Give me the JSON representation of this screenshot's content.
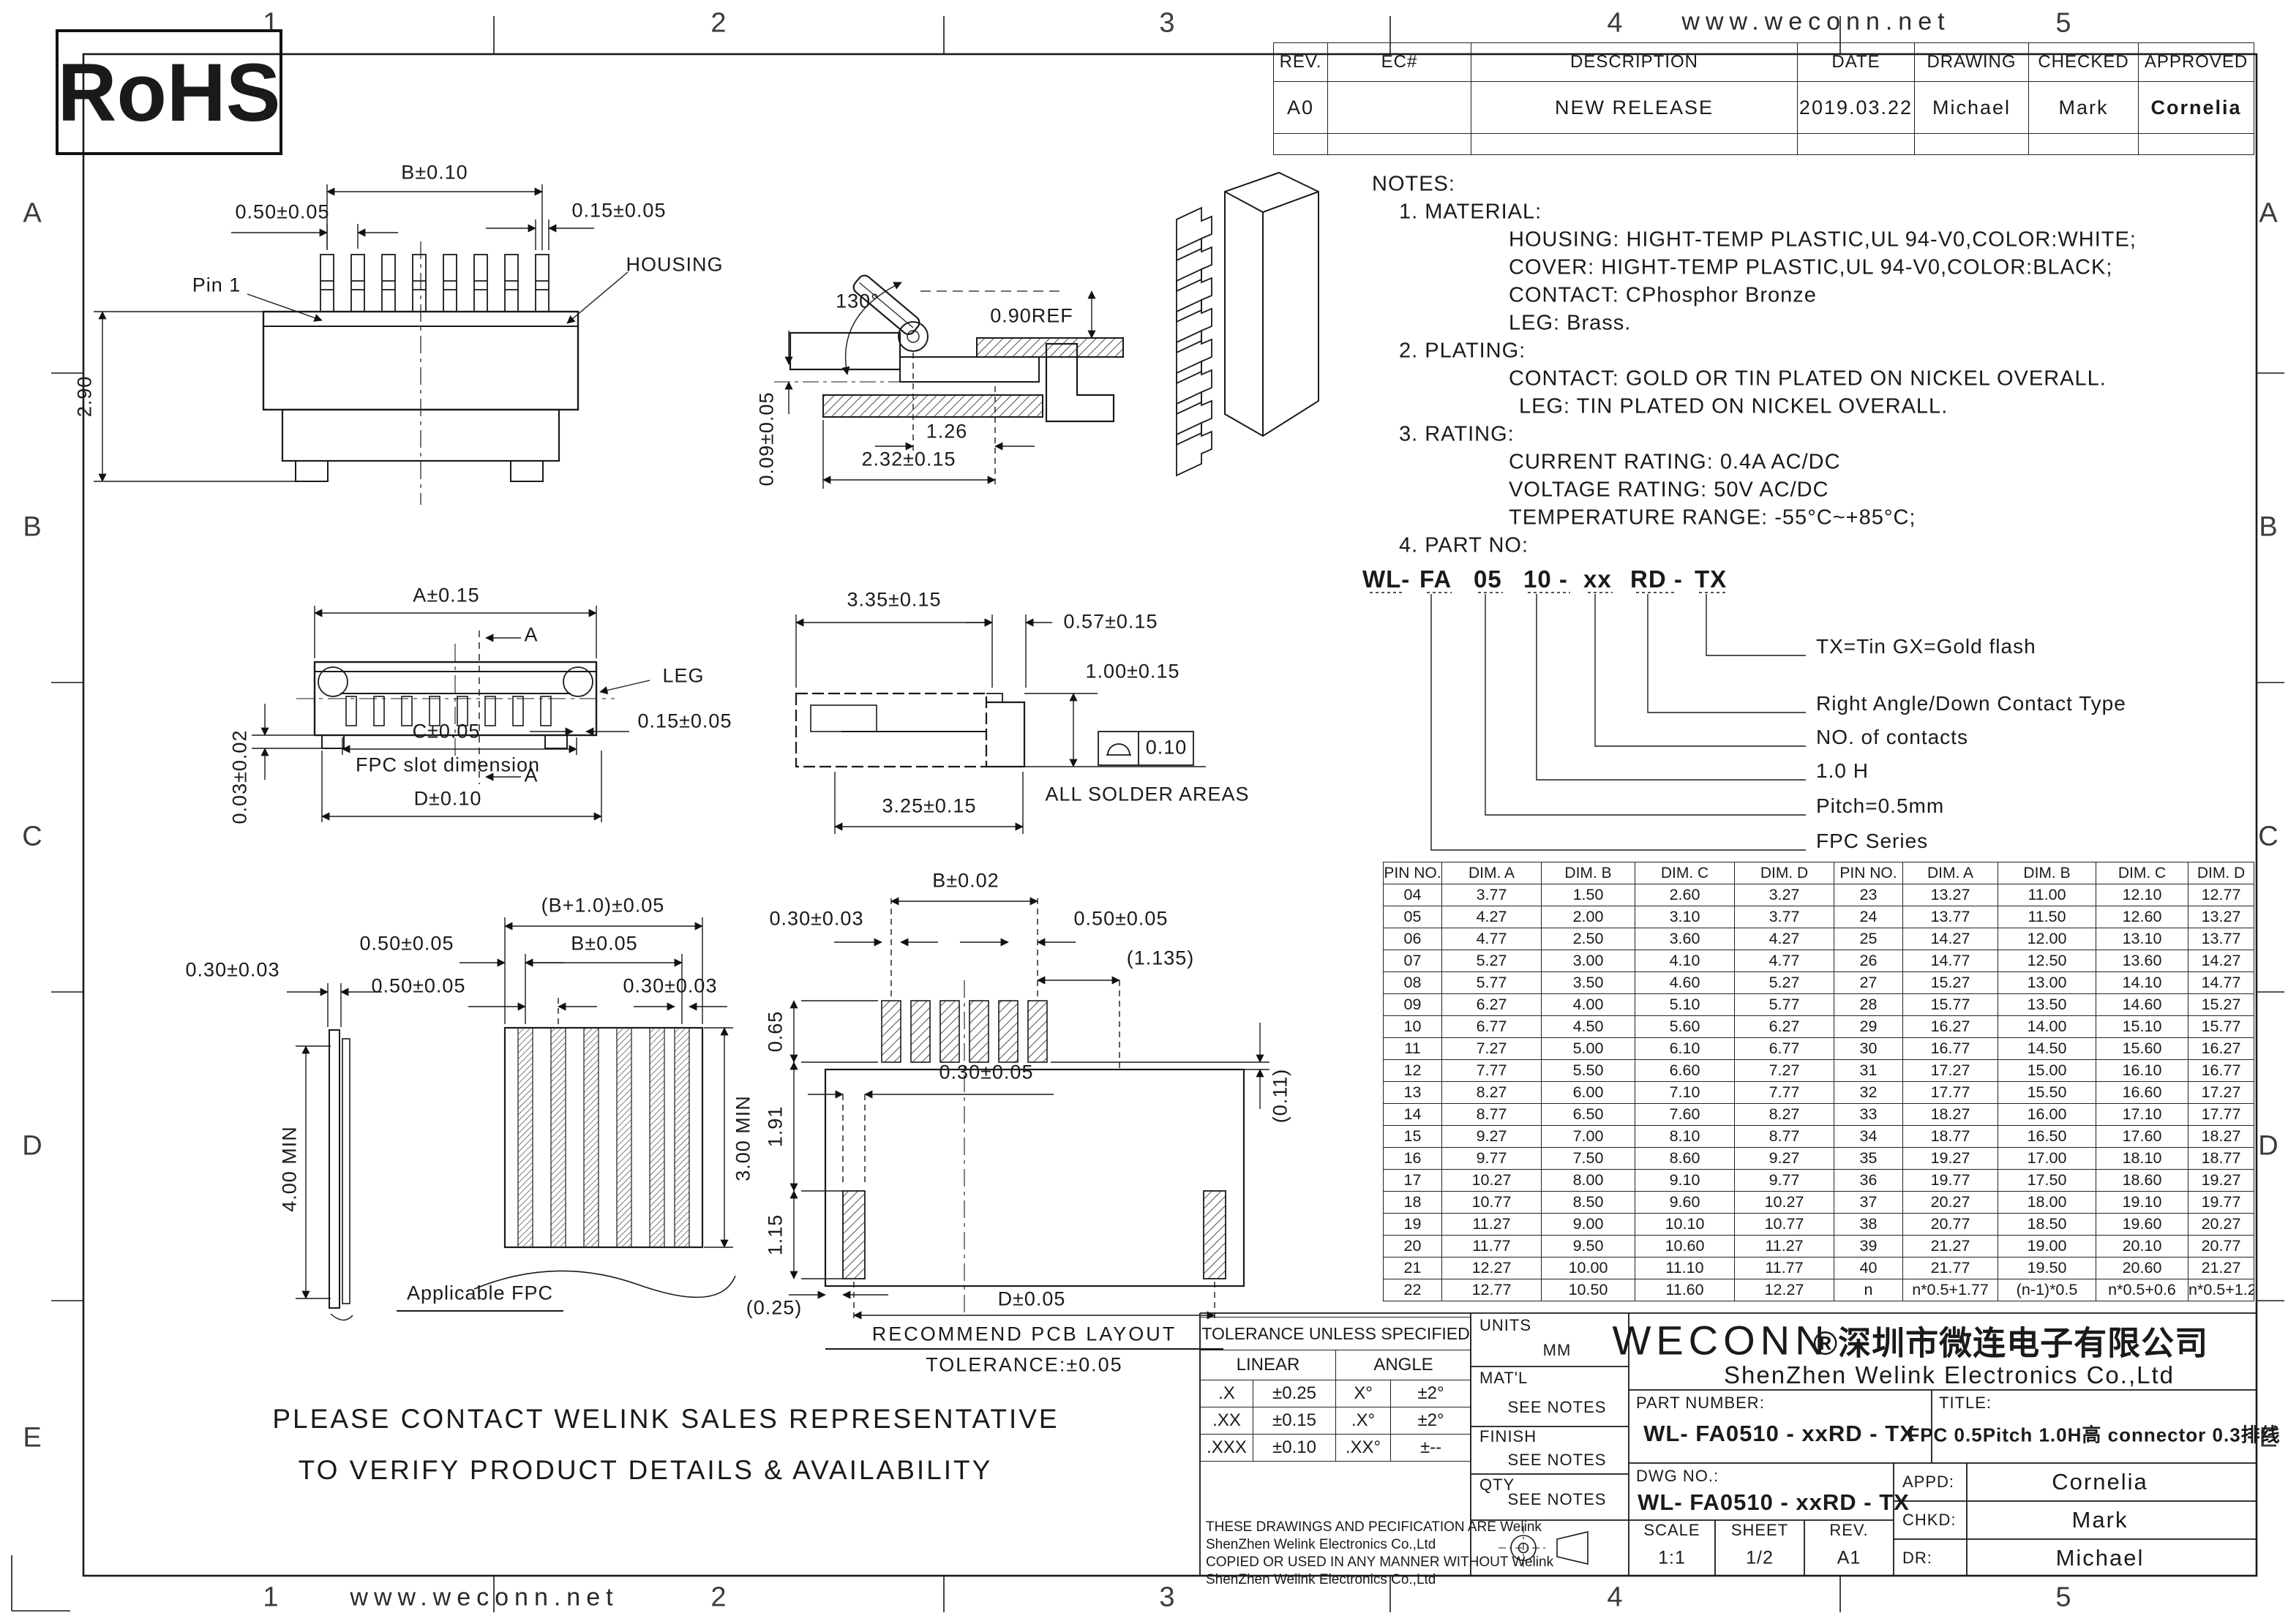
{
  "page": {
    "site": "www.weconn.net",
    "rohs": "RoHS",
    "zone_cols": [
      "1",
      "2",
      "3",
      "4",
      "5"
    ],
    "zone_rows": [
      "A",
      "B",
      "C",
      "D",
      "E"
    ],
    "footer_line1": "PLEASE CONTACT WELINK SALES REPRESENTATIVE",
    "footer_line2": "TO VERIFY PRODUCT DETAILS & AVAILABILITY"
  },
  "rev_table": {
    "headers": [
      "REV.",
      "EC#",
      "DESCRIPTION",
      "DATE",
      "DRAWING",
      "CHECKED",
      "APPROVED"
    ],
    "row": {
      "rev": "A0",
      "ec": "",
      "description": "NEW RELEASE",
      "date": "2019.03.22",
      "drawing": "Michael",
      "checked": "Mark",
      "approved": "Cornelia"
    }
  },
  "notes": {
    "l0": "NOTES:",
    "l1": "1. MATERIAL:",
    "l2": "HOUSING: HIGHT-TEMP PLASTIC,UL 94-V0,COLOR:WHITE;",
    "l3": "COVER: HIGHT-TEMP PLASTIC,UL 94-V0,COLOR:BLACK;",
    "l4": "CONTACT: CPhosphor Bronze",
    "l5": "LEG: Brass.",
    "l6": "2. PLATING:",
    "l7": "CONTACT: GOLD OR TIN PLATED ON NICKEL OVERALL.",
    "l8": "LEG: TIN PLATED ON NICKEL OVERALL.",
    "l9": "3. RATING:",
    "l10": "CURRENT RATING: 0.4A AC/DC",
    "l11": "VOLTAGE RATING: 50V AC/DC",
    "l12": "TEMPERATURE RANGE: -55°C~+85°C;",
    "l13": "4. PART NO:"
  },
  "part_no": {
    "seg1": "WL-",
    "seg2": "FA",
    "seg3": "05",
    "seg4": "10 -",
    "seg5": "xx",
    "seg6": "RD -",
    "seg7": "TX"
  },
  "part_labels": {
    "plating": "TX=Tin  GX=Gold flash",
    "contact": "Right Angle/Down Contact Type",
    "num": "NO. of contacts",
    "height": "1.0 H",
    "pitch": "Pitch=0.5mm",
    "series": "FPC Series"
  },
  "view_front": {
    "dim_b": "B±0.10",
    "dim_pitch": "0.50±0.05",
    "dim_pin_w": "0.15±0.05",
    "pin1": "Pin 1",
    "housing": "HOUSING",
    "dim_h": "2.90"
  },
  "view_side": {
    "angle": "130°",
    "ref": "0.90REF",
    "dim_126": "1.26",
    "dim_232": "2.32±0.15",
    "dim_009": "0.09±0.05"
  },
  "view_bottom": {
    "dim_a": "A±0.15",
    "sec": "A",
    "leg": "LEG",
    "dim_015": "0.15±0.05",
    "dim_c": "C±0.05",
    "slot": "FPC slot dimension",
    "dim_d": "D±0.10",
    "dim_003": "0.03±0.02"
  },
  "view_profile": {
    "dim_335": "3.35±0.15",
    "dim_057": "0.57±0.15",
    "dim_100": "1.00±0.15",
    "dim_325": "3.25±0.15",
    "flat": "0.10",
    "solder": "ALL SOLDER AREAS"
  },
  "view_fpc": {
    "dim_b1": "(B+1.0)±0.05",
    "dim_050a": "0.50±0.05",
    "dim_b": "B±0.05",
    "dim_050b": "0.50±0.05",
    "dim_030r": "0.30±0.03",
    "dim_030l": "0.30±0.03",
    "dim_400": "4.00 MIN",
    "dim_300": "3.00 MIN",
    "caption": "Applicable FPC"
  },
  "view_pcb": {
    "dim_b": "B±0.02",
    "dim_030": "0.30±0.03",
    "dim_050": "0.50±0.05",
    "dim_1135": "(1.135)",
    "dim_065": "0.65",
    "dim_191": "1.91",
    "dim_030c": "0.30±0.05",
    "dim_115": "1.15",
    "dim_011": "(0.11)",
    "dim_025": "(0.25)",
    "dim_d": "D±0.05",
    "caption1": "RECOMMEND PCB LAYOUT",
    "caption2": "TOLERANCE:±0.05"
  },
  "dim_table": {
    "headers": [
      "PIN NO.",
      "DIM. A",
      "DIM. B",
      "DIM. C",
      "DIM. D"
    ],
    "left_rows": [
      [
        "04",
        "3.77",
        "1.50",
        "2.60",
        "3.27"
      ],
      [
        "05",
        "4.27",
        "2.00",
        "3.10",
        "3.77"
      ],
      [
        "06",
        "4.77",
        "2.50",
        "3.60",
        "4.27"
      ],
      [
        "07",
        "5.27",
        "3.00",
        "4.10",
        "4.77"
      ],
      [
        "08",
        "5.77",
        "3.50",
        "4.60",
        "5.27"
      ],
      [
        "09",
        "6.27",
        "4.00",
        "5.10",
        "5.77"
      ],
      [
        "10",
        "6.77",
        "4.50",
        "5.60",
        "6.27"
      ],
      [
        "11",
        "7.27",
        "5.00",
        "6.10",
        "6.77"
      ],
      [
        "12",
        "7.77",
        "5.50",
        "6.60",
        "7.27"
      ],
      [
        "13",
        "8.27",
        "6.00",
        "7.10",
        "7.77"
      ],
      [
        "14",
        "8.77",
        "6.50",
        "7.60",
        "8.27"
      ],
      [
        "15",
        "9.27",
        "7.00",
        "8.10",
        "8.77"
      ],
      [
        "16",
        "9.77",
        "7.50",
        "8.60",
        "9.27"
      ],
      [
        "17",
        "10.27",
        "8.00",
        "9.10",
        "9.77"
      ],
      [
        "18",
        "10.77",
        "8.50",
        "9.60",
        "10.27"
      ],
      [
        "19",
        "11.27",
        "9.00",
        "10.10",
        "10.77"
      ],
      [
        "20",
        "11.77",
        "9.50",
        "10.60",
        "11.27"
      ],
      [
        "21",
        "12.27",
        "10.00",
        "11.10",
        "11.77"
      ],
      [
        "22",
        "12.77",
        "10.50",
        "11.60",
        "12.27"
      ]
    ],
    "right_rows": [
      [
        "23",
        "13.27",
        "11.00",
        "12.10",
        "12.77"
      ],
      [
        "24",
        "13.77",
        "11.50",
        "12.60",
        "13.27"
      ],
      [
        "25",
        "14.27",
        "12.00",
        "13.10",
        "13.77"
      ],
      [
        "26",
        "14.77",
        "12.50",
        "13.60",
        "14.27"
      ],
      [
        "27",
        "15.27",
        "13.00",
        "14.10",
        "14.77"
      ],
      [
        "28",
        "15.77",
        "13.50",
        "14.60",
        "15.27"
      ],
      [
        "29",
        "16.27",
        "14.00",
        "15.10",
        "15.77"
      ],
      [
        "30",
        "16.77",
        "14.50",
        "15.60",
        "16.27"
      ],
      [
        "31",
        "17.27",
        "15.00",
        "16.10",
        "16.77"
      ],
      [
        "32",
        "17.77",
        "15.50",
        "16.60",
        "17.27"
      ],
      [
        "33",
        "18.27",
        "16.00",
        "17.10",
        "17.77"
      ],
      [
        "34",
        "18.77",
        "16.50",
        "17.60",
        "18.27"
      ],
      [
        "35",
        "19.27",
        "17.00",
        "18.10",
        "18.77"
      ],
      [
        "36",
        "19.77",
        "17.50",
        "18.60",
        "19.27"
      ],
      [
        "37",
        "20.27",
        "18.00",
        "19.10",
        "19.77"
      ],
      [
        "38",
        "20.77",
        "18.50",
        "19.60",
        "20.27"
      ],
      [
        "39",
        "21.27",
        "19.00",
        "20.10",
        "20.77"
      ],
      [
        "40",
        "21.77",
        "19.50",
        "20.60",
        "21.27"
      ],
      [
        "n",
        "n*0.5+1.77",
        "(n-1)*0.5",
        "n*0.5+0.6",
        "n*0.5+1.27"
      ]
    ]
  },
  "title_block": {
    "tolerance_title": "TOLERANCE UNLESS SPECIFIED",
    "linear": "LINEAR",
    "angle": "ANGLE",
    "tol_rows": [
      [
        ".X",
        "±0.25",
        "X°",
        "±2°"
      ],
      [
        ".XX",
        "±0.15",
        ".X°",
        "±2°"
      ],
      [
        ".XXX",
        "±0.10",
        ".XX°",
        "±--"
      ]
    ],
    "legal": [
      "THESE DRAWINGS AND PECIFICATION  ARE Welink",
      "ShenZhen Welink Electronics Co.,Ltd",
      " COPIED OR USED IN ANY MANNER WITHOUT Welink",
      "ShenZhen Welink Electronics Co.,Ltd"
    ],
    "units_label": "UNITS",
    "units": "MM",
    "matl_label": "MAT'L",
    "matl": "SEE NOTES",
    "finish_label": "FINISH",
    "finish": "SEE NOTES",
    "qty_label": "QTY",
    "qty": "SEE NOTES",
    "brand": "WECONN",
    "company_cn": "®深圳市微连电子有限公司",
    "company_en": "ShenZhen  Welink  Electronics  Co.,Ltd",
    "part_number_label": "PART NUMBER:",
    "part_number": "WL- FA0510 - xxRD - TX",
    "title_label": "TITLE:",
    "title": "FPC 0.5Pitch 1.0H高 connector  0.3排线",
    "dwg_label": "DWG NO.:",
    "dwg": "WL- FA0510 - xxRD - TX",
    "scale_label": "SCALE",
    "scale": "1:1",
    "sheet_label": "SHEET",
    "sheet": "1/2",
    "rev_label": "REV.",
    "rev": "A1",
    "appd_label": "APPD:",
    "appd": "Cornelia",
    "chkd_label": "CHKD:",
    "chkd": "Mark",
    "dr_label": "DR:",
    "dr": "Michael"
  }
}
